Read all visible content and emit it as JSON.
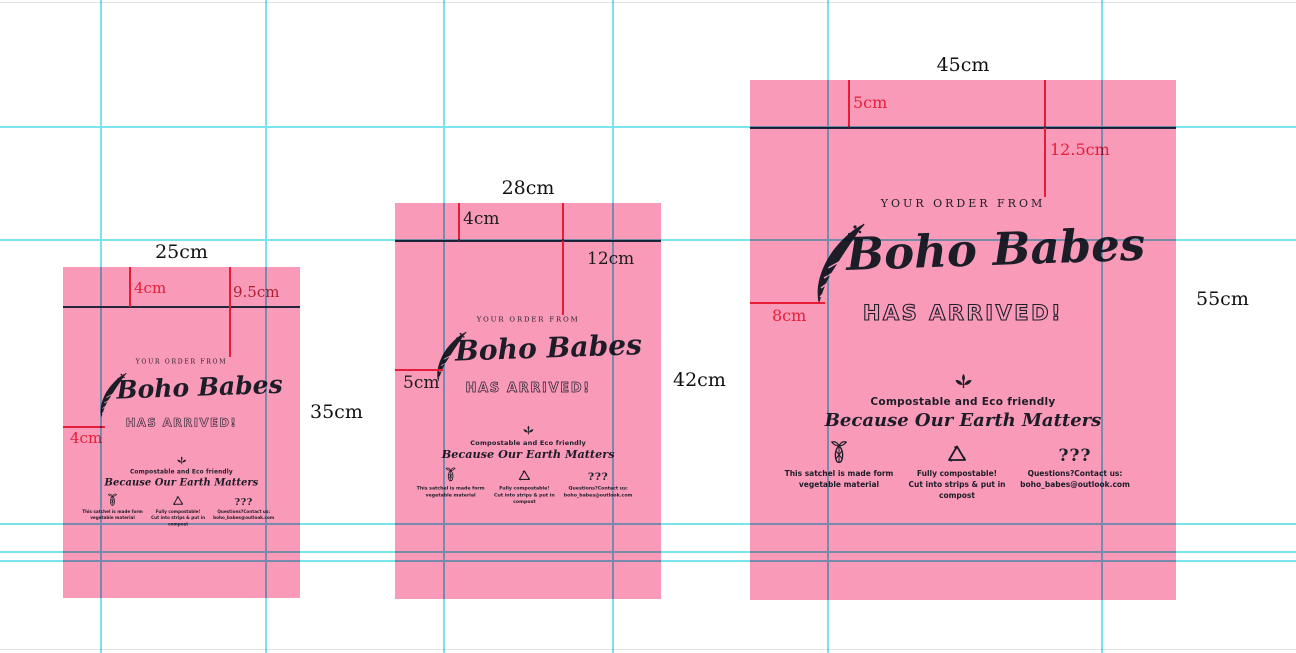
{
  "colors": {
    "bag_pink": "#f99ab9",
    "guide_cyan": "#7ae4ee",
    "fold_line_dark": "#23263c",
    "dimension_red": "#e51e38",
    "label_black": "#111111"
  },
  "bag_content": {
    "order_from": "YOUR ORDER FROM",
    "brand": "Boho Babes",
    "arrived": "HAS ARRIVED!",
    "eco_heading": "Compostable and Eco friendly",
    "eco_tagline": "Because Our Earth Matters",
    "questions_glyph": "???",
    "info_columns": [
      {
        "icon": "corn-icon",
        "line1": "This satchel is made form",
        "line2": "vegetable material"
      },
      {
        "icon": "recycle-icon",
        "line1": "Fully compostable!",
        "line2": "Cut into strips & put in compost"
      },
      {
        "icon": "questions-icon",
        "line1": "Questions?Contact us:",
        "line2": "boho_babes@outlook.com"
      }
    ]
  },
  "bags": {
    "small": {
      "width_label": "25cm",
      "height_label": "35cm",
      "flap_label": "4cm",
      "seal_label": "9.5cm",
      "bottom_label": "4cm"
    },
    "medium": {
      "width_label": "28cm",
      "height_label": "42cm",
      "flap_label": "4cm",
      "seal_label": "12cm",
      "bottom_label": "5cm"
    },
    "large": {
      "width_label": "45cm",
      "height_label": "55cm",
      "flap_label": "5cm",
      "seal_label": "12.5cm",
      "bottom_label": "8cm"
    }
  }
}
